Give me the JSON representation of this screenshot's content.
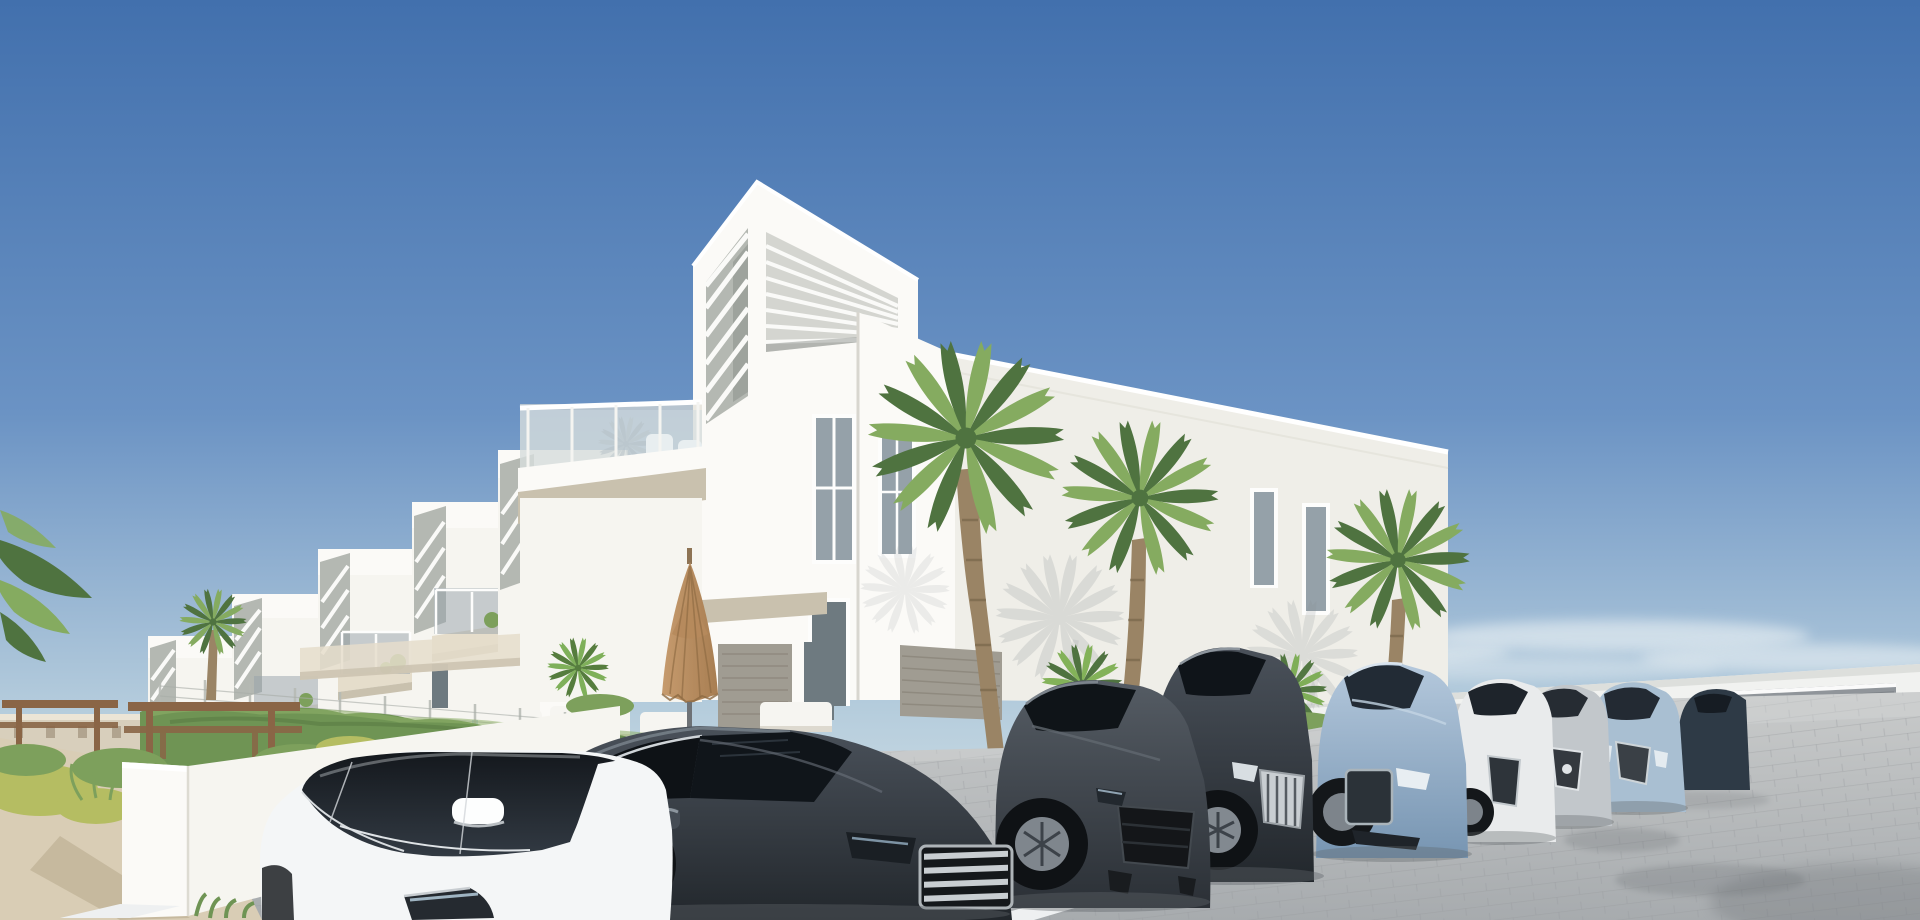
{
  "meta": {
    "kind": "photorealistic architectural exterior render",
    "width_px": 1920,
    "height_px": 920,
    "visible_text": "none"
  },
  "scene": {
    "description": "New-build white modern apartment complex under a clear blue sky. A row of terraced white units steps down to the left; the main block has a rooftop pergola with louvered slats, a glass-railed balcony with white chairs, narrow vertical windows and palm trees in front. A white garden wall with a hedge and wire fence, sandy path, shrubs and wooden picnic tables sit on the left. In the cobblestone parking lot a diagonal row of parked cars faces the viewer: a white sedan, two charcoal sedans, a graphite fastback, a light-blue sedan, a white sedan, a silver sedan and a pale-blue sedan, with white parking lines and soft shadows. A low white boundary wall with a gray garage door sits at the horizon on the right; a closed tan patio umbrella and white outdoor sofas stand behind the hedge.",
    "elements": [
      {
        "name": "sky",
        "detail": "clear gradient sky, faint clouds near horizon"
      },
      {
        "name": "main-building",
        "detail": "white block with rooftop louvered pergola"
      },
      {
        "name": "terraced-units",
        "detail": "six stepped white townhouse units receding left"
      },
      {
        "name": "balcony",
        "detail": "glass railing, white chairs, palm shadow"
      },
      {
        "name": "palm-trees",
        "detail": "three large fan palms plus small palms and shrubs"
      },
      {
        "name": "umbrella",
        "detail": "closed tan patio umbrella"
      },
      {
        "name": "outdoor-sofas",
        "detail": "white cushion seating behind hedge"
      },
      {
        "name": "garden-wall",
        "detail": "white rendered wall with hedge and wire fence"
      },
      {
        "name": "picnic-tables",
        "detail": "two wooden picnic tables on sandy path"
      },
      {
        "name": "parking-lot",
        "detail": "gray cobblestone pavers, white stall lines"
      },
      {
        "name": "cars",
        "detail": "nine parked cars in a diagonal row"
      },
      {
        "name": "boundary-wall",
        "detail": "distant white wall with gray garage door"
      }
    ]
  },
  "palette": {
    "sky_top": "#4270ad",
    "sky_mid": "#6b93c4",
    "sky_low": "#b7cedd",
    "sky_horizon": "#dfe7ea",
    "cloud": "#edf3f5",
    "wall_bright": "#fbfaf7",
    "wall_face": "#f6f5f0",
    "wall_side": "#efeee8",
    "wall_shade": "#e0dfd6",
    "wall_recess": "#b4b8b2",
    "wall_deep": "#8f948f",
    "slat_white": "#fafaf8",
    "window_glass": "#95a1a9",
    "window_dark": "#6e7a80",
    "slab_beige": "#e5ddcb",
    "slab_underside": "#c9c1ae",
    "hedge_green": "#6f9454",
    "pl": "#85ab60",
    "pd": "#4f7340",
    "palm_trunk": "#9a8465",
    "sand_path": "#d9cdb5",
    "bush_yellow": "#b5bd62",
    "bush_green": "#7da05c",
    "picnic_wood": "#8a6546",
    "pavement_far": "#c9cbcb",
    "pavement_near": "#a7abae",
    "paver_joint": "#96999c",
    "parking_line": "#eef0f1",
    "ground_shadow": "#5f6468",
    "door_gray": "#a09c92",
    "garage_gray": "#90959a",
    "umbrella_tan": "#c69b6e",
    "umbrella_dark": "#a87e52",
    "car_white": "#f4f6f7",
    "car_charcoal": "#343a41",
    "car_graphite": "#3f454c",
    "car_darkgray": "#363c44",
    "car_blue": "#8aa8c6",
    "car_pearl": "#e9ebec",
    "car_silver": "#c2c7cb",
    "car_paleblue": "#a9bfd2",
    "car_darkblue": "#2e3a46",
    "glass_dark": "#10151a",
    "chrome": "#c9ced2"
  }
}
